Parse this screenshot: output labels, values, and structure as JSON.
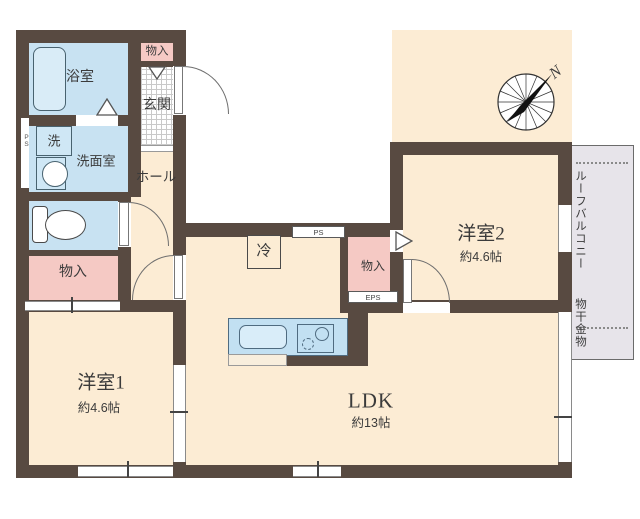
{
  "compass": {
    "north_label": "N"
  },
  "rooms": {
    "bathroom": "浴室",
    "closet_top": "物入",
    "entrance": "玄関",
    "washer": "洗",
    "washroom": "洗面室",
    "hall": "ホール",
    "closet_mid": "物入",
    "closet_center": "物入",
    "fridge": "冷",
    "room1_name": "洋室1",
    "room1_size": "約4.6帖",
    "room2_name": "洋室2",
    "room2_size": "約4.6帖",
    "ldk_name": "LDK",
    "ldk_size": "約13帖",
    "balcony_line1": "ルーフバルコニー",
    "balcony_line2": "物干金物",
    "ps_shaft_left": "PS",
    "ps_shaft_top": "PS",
    "eps_shaft": "EPS"
  },
  "colors": {
    "wall": "#584a41",
    "room_floor": "#fcecd4",
    "wet_area": "#c8e2f2",
    "closet": "#f5c9c4",
    "balcony": "#e7e4ea"
  }
}
